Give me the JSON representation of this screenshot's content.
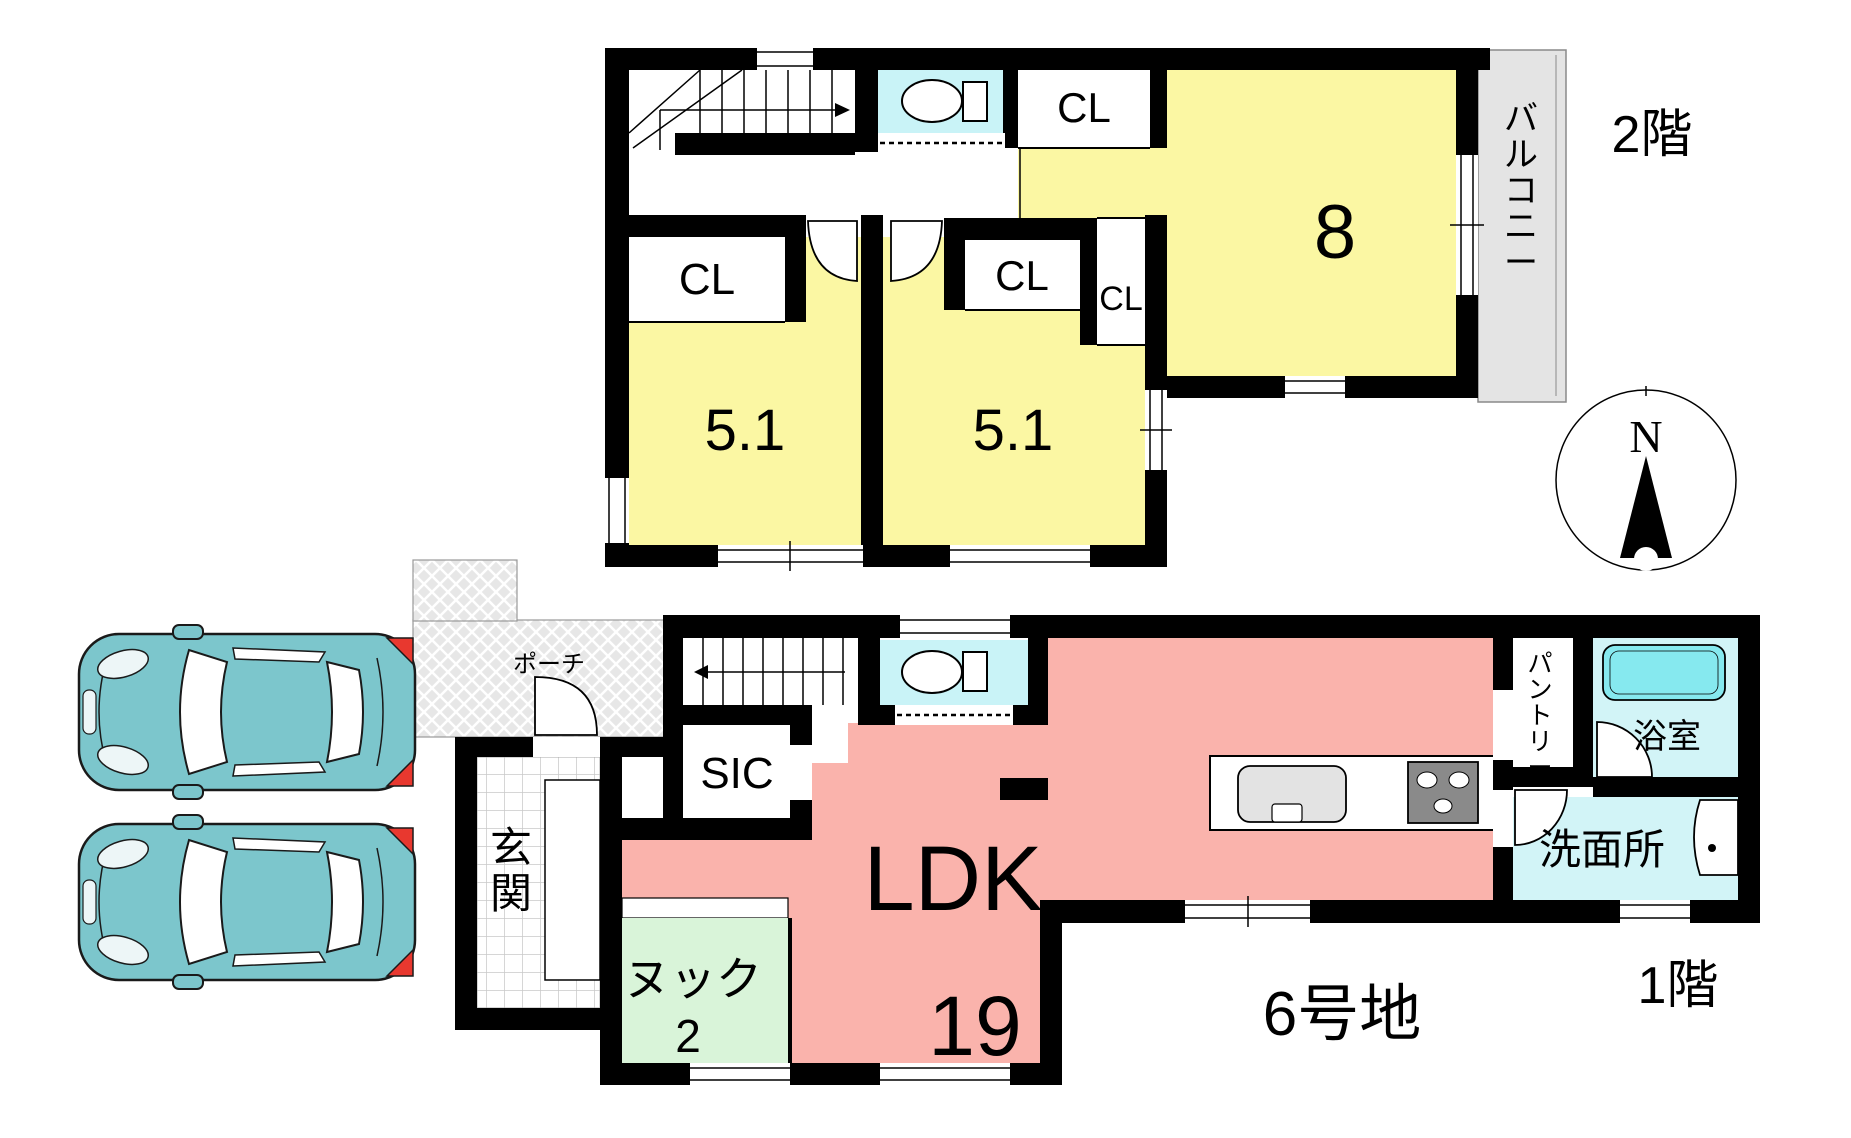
{
  "colors": {
    "room_yellow": "#FBF7A3",
    "ldk_pink": "#FAB3AC",
    "nook_green": "#D9F4D9",
    "wet_cyan": "#C9F3F7",
    "tub_cyan": "#85E8EF",
    "balcony_gray": "#E4E4E4",
    "car_teal": "#7CC6CC",
    "wall_black": "#000000"
  },
  "floor2": {
    "floor_label": "2階",
    "room8": "8",
    "room51_left": "5.1",
    "room51_right": "5.1",
    "closet_top": "CL",
    "closet_left": "CL",
    "closet_mid": "CL",
    "closet_small": "CL",
    "balcony_chars": [
      "バ",
      "ル",
      "コ",
      "ニ",
      "ー"
    ],
    "compass_north": "N"
  },
  "floor1": {
    "floor_label": "1階",
    "lot_label": "6号地",
    "porch_label": "ポーチ",
    "entrance_chars": [
      "玄",
      "関"
    ],
    "shoe_closet": "SIC",
    "ldk_label": "LDK",
    "ldk_size": "19",
    "nook_label": "ヌック",
    "nook_size": "2",
    "pantry_chars": [
      "パ",
      "ン",
      "ト",
      "リ",
      "ー"
    ],
    "bath_label": "浴室",
    "washroom_label": "洗面所"
  }
}
